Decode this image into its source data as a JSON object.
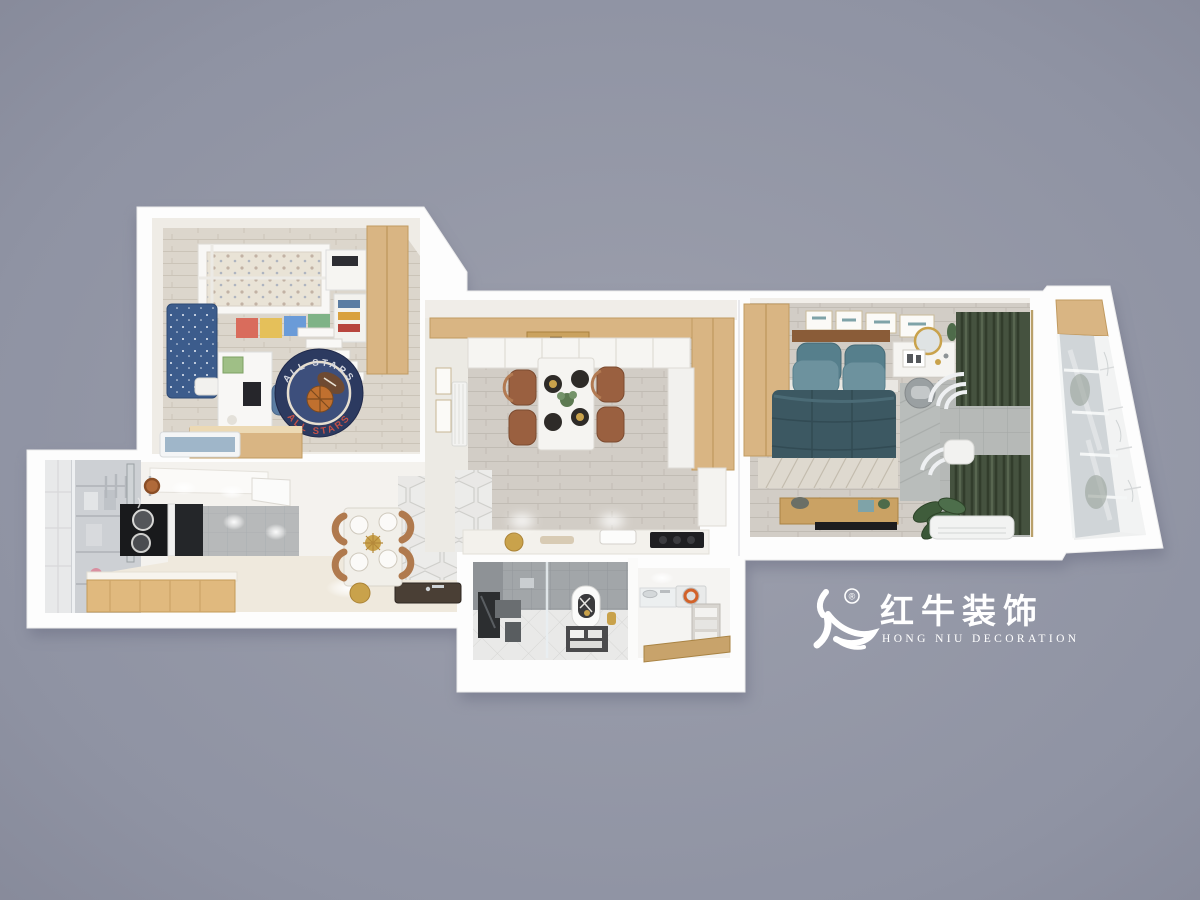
{
  "scene": {
    "type": "3d-floorplan-render",
    "background_color": "#8f93a3"
  },
  "watermark": {
    "registered": "®",
    "brand_cn": "红牛装饰",
    "brand_en": "HONG NIU DECORATION",
    "color": "#ffffff"
  },
  "kids_room": {
    "rug_text_top": "ALL STARS",
    "rug_text_bottom": "ALL STARS"
  },
  "palette": {
    "wall": "#ffffff",
    "wood_cabinet": "#d9b583",
    "floor_wood": "#d2cdc6",
    "hex_tile": "#e9e8e6",
    "navy_rug": "#2c3a60",
    "rug_letters_red": "#c25048",
    "star_bedding": "#3c5c8c",
    "teal_duvet": "#3c5862",
    "teal_pillow": "#6d929e",
    "curtain_green": "#45523f",
    "dining_chair_brown": "#9a6040",
    "bath_tile": "#a2a6a9",
    "basketball_orange": "#c0702f"
  }
}
